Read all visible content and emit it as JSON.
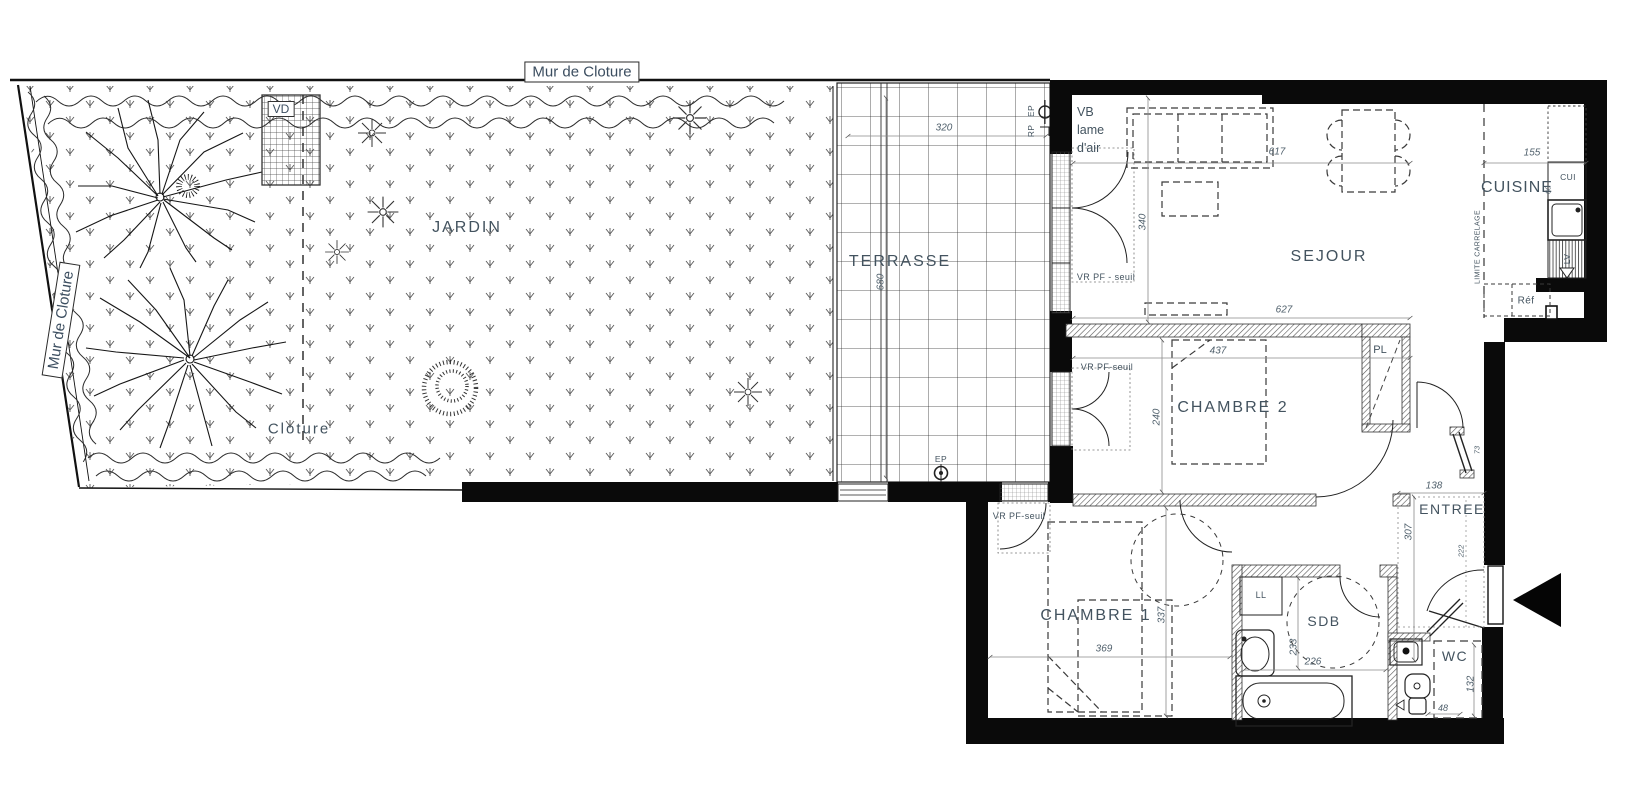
{
  "plan": {
    "labels": {
      "mur_top": "Mur de Cloture",
      "mur_left": "Mur de Cloture",
      "vd": "VD",
      "jardin": "JARDIN",
      "cloture": "Cloture",
      "terrasse": "TERRASSE",
      "vb_line1": "VB",
      "vb_line2": "lame",
      "vb_line3": "d'air",
      "vr_seuil_sejour": "VR PF - seuil",
      "vr_seuil_ch2": "VR PF-seuil",
      "vr_seuil_ch1": "VR PF-seuil",
      "sejour": "SEJOUR",
      "cuisine": "CUISINE",
      "cui": "CUI",
      "lv": "LV",
      "ref": "Réf",
      "limite_carrelage": "LIMITE CARRELAGE",
      "chambre2": "CHAMBRE 2",
      "pl": "PL",
      "pl_depth": "55",
      "entree": "ENTREE",
      "chambre1": "CHAMBRE 1",
      "sdb": "SDB",
      "ll": "LL",
      "wc": "WC",
      "ep_roof": "EP",
      "rp": "RP",
      "ep_terrace": "EP"
    },
    "dims": {
      "terrasse_w": "320",
      "terrasse_h": "680",
      "sejour_w": "617",
      "sejour_w2": "627",
      "sejour_h": "340",
      "cuisine_w": "155",
      "cuisine_d": "60",
      "ch2_w": "437",
      "ch2_h": "240",
      "entree_w": "138",
      "entree_h": "307",
      "entree_nook": "222",
      "hall_door": "73",
      "ch1_w": "369",
      "ch1_h": "337",
      "sdb_h": "233",
      "sdb_w": "226",
      "wc_h": "132",
      "wc_w": "48"
    }
  }
}
